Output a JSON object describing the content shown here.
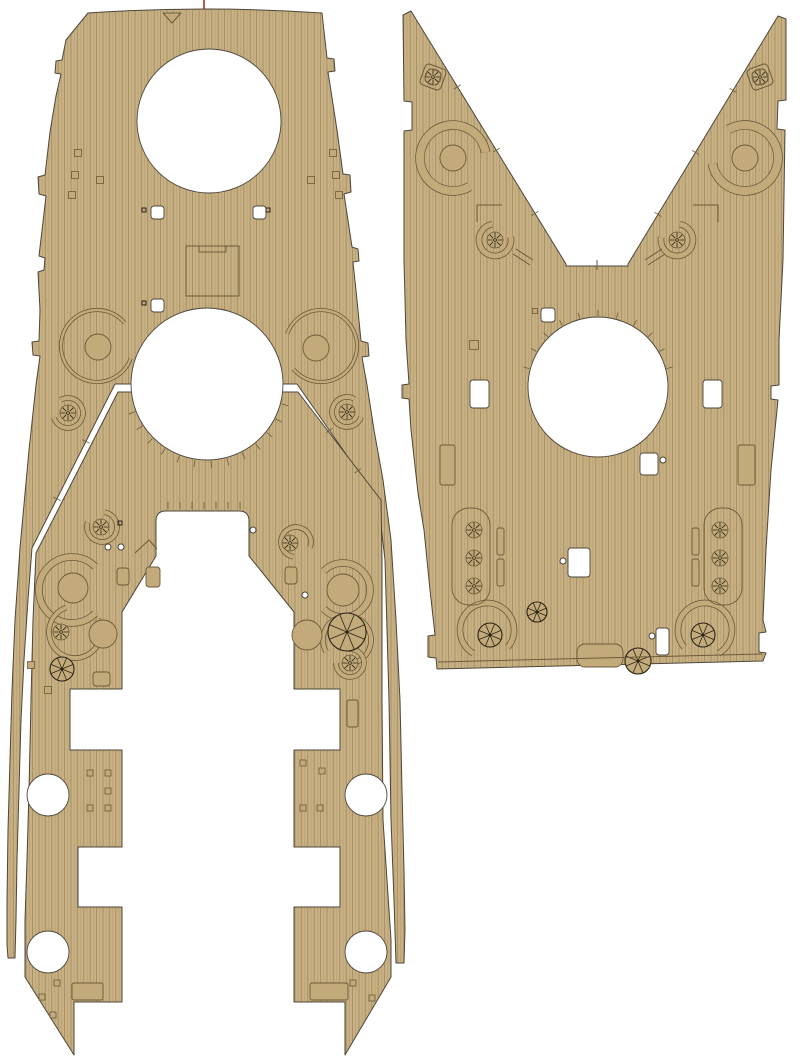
{
  "meta": {
    "label": "wooden-deck-plating-template-sheet"
  },
  "canvas": {
    "width": 800,
    "height": 1057
  },
  "colors": {
    "background": "#ffffff",
    "deck": "#c8b083",
    "plank_line": "#97855c",
    "plank_line2": "#a7956c",
    "edge": "#4e463a",
    "detail": "#6b5b3a",
    "ink": "#2b2417",
    "decor": "#c3aa7a",
    "hole": "#ffffff",
    "registration": "#a1251b"
  },
  "pieces": [
    {
      "name": "forecastle-deck-piece",
      "path": "M 88,13 Q 205,5 322,13 L 327,58 L 334,59 L 335,71 L 328,72 L 337,130 L 343,174 L 350,175 L 351,192 L 344,194 L 352,247 L 358,249 L 359,261 L 353,262 L 357,300 L 361,341 L 368,343 L 369,356 L 362,357 L 367,385 L 374,430 L 383,480 L 391,540 L 396,620 L 400,700 L 402,790 L 404,870 L 405,930 L 404,963 L 396,963 L 394,900 L 391,820 L 389,700 L 385,560 L 378,500 L 297,384 L 115,384 L 32,548 L 28,600 L 24,660 L 21,720 L 19,790 L 17,860 L 16,920 L 15,958 L 8,958 L 7,945 L 7,900 L 8,830 L 10,760 L 12,690 L 15,620 L 20,548 L 29,450 L 36,385 L 40,356 L 33,355 L 32,342 L 39,341 L 40,310 L 38,272 L 44,270 L 45,258 L 39,256 L 46,196 L 39,194 L 38,177 L 45,175 L 50,132 L 56,96 L 61,74 L 55,73 L 56,61 L 62,60 L 66,40 Z"
    },
    {
      "name": "main-deck-piece",
      "path": "M 118,392 L 298,392 L 381,500 L 382,560 L 382,700 L 383,820 L 387,880 L 391,940 L 391,977 L 345,1055 L 345,1002 L 294,1002 L 294,907 L 340,907 L 340,847 L 294,847 L 294,750 L 340,750 L 340,689 L 294,689 L 294,612 L 249,556 L 249,521 Q 249,511 239,511 L 166,511 Q 156,511 156,521 L 156,556 L 122,612 L 122,689 L 70,689 L 70,750 L 122,750 L 122,847 L 78,847 L 78,907 L 122,907 L 122,1002 L 74,1002 L 74,1055 L 25,977 L 25,920 L 27,860 L 29,790 L 31,700 L 33,620 L 36,553 Z"
    },
    {
      "name": "aft-deck-piece",
      "path": "M 403,15 L 411,11 L 566,264 L 566,266 L 597,266 L 628,266 L 628,264 L 778,16 L 786,19 L 786,100 L 778,101 L 777,129 L 785,130 L 783,260 L 779,340 L 779,385 L 771,386 L 771,399 L 778,400 L 771,470 L 766,550 L 763,620 L 766,632 L 759,633 L 759,652 L 766,653 L 763,661 L 437,669 L 436,658 L 428,657 L 428,636 L 435,635 L 430,590 L 424,530 L 418,493 L 411,430 L 409,399 L 402,398 L 402,385 L 409,384 L 406,340 L 404,260 L 404,131 L 412,130 L 412,102 L 404,101 Z"
    }
  ],
  "cutouts": {
    "circles": [
      [
        209,
        121,
        72
      ],
      [
        207,
        384,
        76
      ],
      [
        48,
        795,
        21
      ],
      [
        48,
        952,
        21
      ],
      [
        366,
        795,
        21
      ],
      [
        366,
        952,
        21
      ],
      [
        598,
        387,
        70
      ]
    ],
    "rects": [
      [
        151,
        206,
        13,
        13
      ],
      [
        253,
        206,
        13,
        13
      ],
      [
        151,
        299,
        13,
        13
      ],
      [
        470,
        380,
        19,
        28
      ],
      [
        703,
        380,
        19,
        28
      ],
      [
        640,
        453,
        18,
        22
      ],
      [
        568,
        548,
        22,
        29
      ],
      [
        656,
        628,
        13,
        27
      ],
      [
        541,
        308,
        14,
        14
      ]
    ]
  },
  "fittings": {
    "rings": [
      [
        97,
        346,
        36,
        2.5,
        20,
        320
      ],
      [
        321,
        346,
        36,
        2.5,
        -160,
        140
      ],
      [
        68,
        413,
        15,
        4,
        -120,
        160
      ],
      [
        347,
        412,
        15,
        4,
        20,
        300
      ],
      [
        102,
        527,
        15,
        4,
        -80,
        200
      ],
      [
        296,
        542,
        15,
        4,
        100,
        380
      ],
      [
        72,
        590,
        33,
        6,
        45,
        315
      ],
      [
        343,
        590,
        27,
        6,
        -135,
        135
      ],
      [
        75,
        632,
        26,
        4,
        -30,
        250
      ],
      [
        347,
        640,
        24,
        4,
        150,
        430
      ],
      [
        350,
        663,
        14,
        4,
        -100,
        180
      ],
      [
        453,
        158,
        33,
        8,
        60,
        350
      ],
      [
        745,
        158,
        33,
        8,
        -120,
        170
      ],
      [
        495,
        240,
        16,
        5,
        -10,
        260
      ],
      [
        677,
        240,
        16,
        5,
        -80,
        190
      ],
      [
        487,
        630,
        27,
        5,
        120,
        400
      ],
      [
        705,
        630,
        27,
        5,
        140,
        420
      ]
    ],
    "platforms": [
      [
        98,
        347,
        13
      ],
      [
        316,
        348,
        13
      ],
      [
        73,
        588,
        15
      ],
      [
        343,
        590,
        16
      ],
      [
        103,
        634,
        14
      ],
      [
        307,
        635,
        15
      ],
      [
        453,
        158,
        13
      ],
      [
        745,
        158,
        13
      ]
    ],
    "pinwheels": [
      [
        62,
        669,
        12
      ],
      [
        347,
        632,
        19
      ],
      [
        490,
        635,
        12
      ],
      [
        703,
        635,
        12
      ],
      [
        537,
        612,
        10
      ],
      [
        638,
        661,
        13
      ]
    ],
    "capstans": [
      [
        68,
        413
      ],
      [
        347,
        412
      ],
      [
        101,
        527
      ],
      [
        290,
        543
      ],
      [
        61,
        632
      ],
      [
        350,
        663
      ],
      [
        433,
        77
      ],
      [
        760,
        77
      ],
      [
        495,
        240
      ],
      [
        677,
        240
      ],
      [
        474,
        530
      ],
      [
        474,
        558
      ],
      [
        474,
        586
      ],
      [
        720,
        530
      ],
      [
        720,
        558
      ],
      [
        720,
        586
      ]
    ],
    "pads": [
      [
        433,
        77,
        22,
        20
      ],
      [
        760,
        77,
        22,
        -20
      ]
    ],
    "squares": [
      [
        78,
        153,
        7
      ],
      [
        75,
        175,
        7
      ],
      [
        72,
        195,
        7
      ],
      [
        100,
        180,
        7
      ],
      [
        333,
        153,
        7
      ],
      [
        336,
        175,
        7
      ],
      [
        339,
        195,
        7
      ],
      [
        311,
        180,
        7
      ],
      [
        31,
        665,
        7
      ],
      [
        48,
        690,
        7
      ],
      [
        90,
        773,
        6
      ],
      [
        108,
        773,
        6
      ],
      [
        108,
        791,
        6
      ],
      [
        90,
        808,
        6
      ],
      [
        108,
        808,
        6
      ],
      [
        303,
        763,
        6
      ],
      [
        322,
        771,
        6
      ],
      [
        303,
        808,
        6
      ],
      [
        320,
        808,
        6
      ],
      [
        42,
        997,
        6
      ],
      [
        53,
        1015,
        6
      ],
      [
        57,
        983,
        6
      ],
      [
        353,
        983,
        6
      ],
      [
        372,
        998,
        6
      ],
      [
        474,
        345,
        9
      ],
      [
        535,
        311,
        5
      ]
    ],
    "dark_squares": [
      [
        144,
        210,
        4
      ],
      [
        268,
        210,
        4
      ],
      [
        144,
        303,
        4
      ],
      [
        120,
        523,
        4
      ]
    ],
    "structures": [
      [
        117,
        568,
        12,
        17,
        1,
        3
      ],
      [
        285,
        567,
        12,
        17,
        1,
        3
      ],
      [
        146,
        567,
        14,
        20,
        1,
        3
      ],
      [
        93,
        672,
        17,
        14,
        1,
        3
      ],
      [
        347,
        700,
        11,
        27,
        1,
        2
      ],
      [
        72,
        983,
        31,
        17,
        1,
        2
      ],
      [
        310,
        983,
        38,
        17,
        1,
        2
      ],
      [
        440,
        445,
        15,
        40,
        1,
        2
      ],
      [
        738,
        445,
        17,
        40,
        1,
        2
      ],
      [
        577,
        644,
        46,
        23,
        1,
        8
      ],
      [
        497,
        528,
        7,
        27,
        1,
        2
      ],
      [
        497,
        559,
        7,
        27,
        1,
        2
      ],
      [
        692,
        528,
        7,
        27,
        1,
        2
      ],
      [
        692,
        559,
        7,
        27,
        1,
        2
      ],
      [
        452,
        508,
        38,
        97,
        0,
        17
      ],
      [
        704,
        508,
        38,
        97,
        0,
        17
      ]
    ],
    "dots": [
      [
        108,
        547
      ],
      [
        121,
        547
      ],
      [
        253,
        530
      ],
      [
        305,
        595
      ],
      [
        663,
        460
      ],
      [
        563,
        561
      ],
      [
        652,
        636
      ]
    ],
    "outlines": [
      {
        "d": "M163,13 L181,13 L172,23 Z",
        "f": 1
      },
      {
        "d": "M186,246 H239 V296 H186 Z M199,246 V252 H226 V246",
        "f": 0
      },
      {
        "d": "M438,662 L762,654",
        "f": 0
      },
      {
        "d": "M135,553 L149,540 L157,549",
        "f": 0
      },
      {
        "d": "M477,222 V205 H502",
        "f": 0
      },
      {
        "d": "M718,222 V205 H693",
        "f": 0
      },
      {
        "d": "M516,249 L533,260 M513,254 L530,265",
        "f": 0
      },
      {
        "d": "M645,260 L662,249 M648,265 L665,254",
        "f": 0
      },
      {
        "d": "M597,260 V270",
        "f": 0
      }
    ]
  },
  "ticks": {
    "radial": [
      {
        "cx": 207,
        "cy": 384,
        "r1": 77,
        "r2": 84,
        "a0": 15,
        "a1": 165,
        "step": 12
      },
      {
        "cx": 598,
        "cy": 387,
        "r1": 71,
        "r2": 77,
        "a0": 195,
        "a1": 345,
        "step": 15
      }
    ],
    "vertical": [
      {
        "xs": [
          168,
          180,
          192,
          204,
          216,
          228,
          240
        ],
        "y1": 502,
        "y2": 509
      }
    ],
    "edge": [
      {
        "x1": 411,
        "y1": 11,
        "x2": 566,
        "y2": 264,
        "ts": [
          0.3,
          0.55,
          0.8
        ]
      },
      {
        "x1": 778,
        "y1": 16,
        "x2": 628,
        "y2": 264,
        "ts": [
          0.3,
          0.55,
          0.8
        ]
      },
      {
        "x1": 115,
        "y1": 384,
        "x2": 32,
        "y2": 548,
        "ts": [
          0.35,
          0.7
        ]
      },
      {
        "x1": 297,
        "y1": 384,
        "x2": 378,
        "y2": 500,
        "ts": [
          0.4,
          0.75
        ]
      }
    ]
  },
  "registration_marks": [
    {
      "x1": 204,
      "y1": 0,
      "x2": 204,
      "y2": 9
    }
  ]
}
